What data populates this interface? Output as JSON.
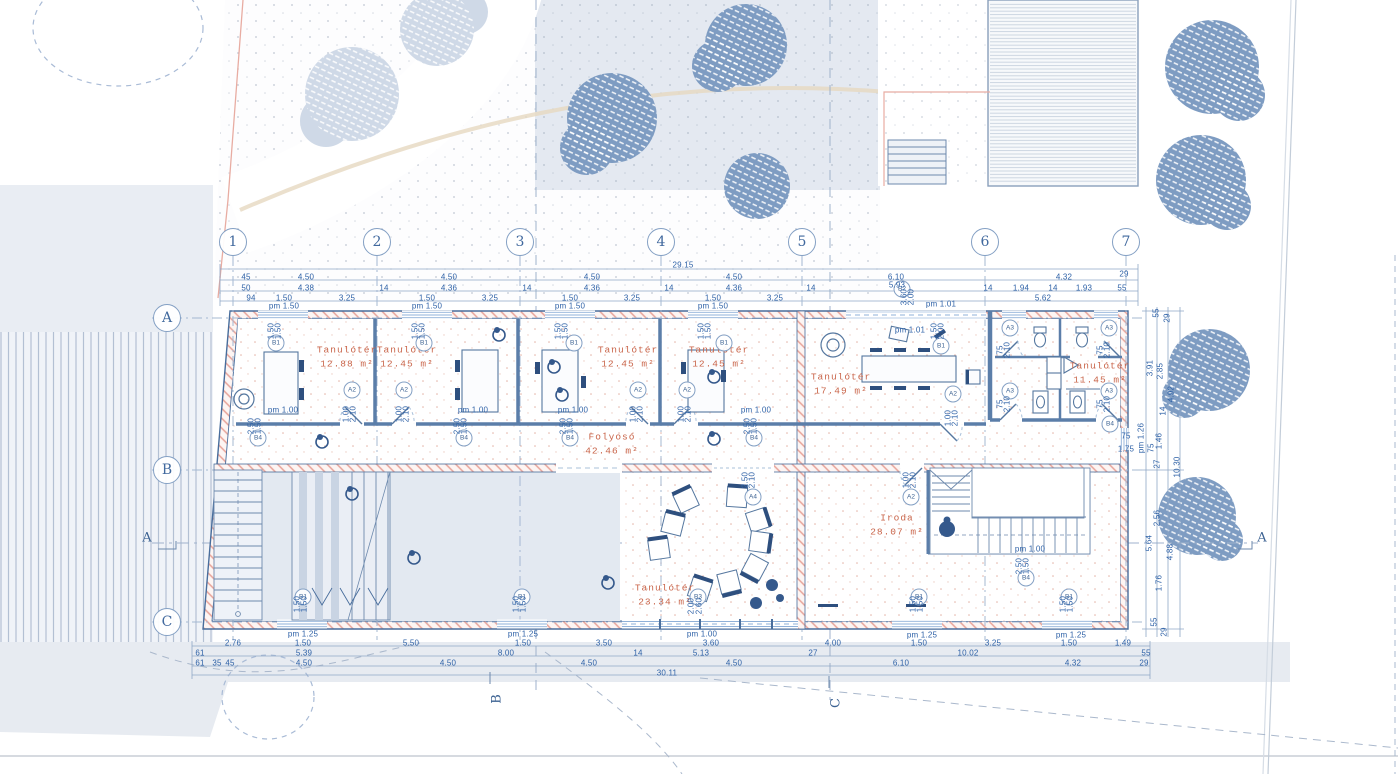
{
  "plan": {
    "title_note": "floor plan",
    "colors": {
      "dim_text": "#2f62a7",
      "room_text": "#c9654a",
      "wall_line": "#486d9c",
      "tree_fill": "#7e9cc2",
      "site_fill": "#e6eaf2",
      "hatch_red": "#e7a399"
    },
    "grid_cols": [
      {
        "n": "1",
        "x": 233,
        "y": 242
      },
      {
        "n": "2",
        "x": 377,
        "y": 242
      },
      {
        "n": "3",
        "x": 520,
        "y": 242
      },
      {
        "n": "4",
        "x": 661,
        "y": 242
      },
      {
        "n": "5",
        "x": 802,
        "y": 242
      },
      {
        "n": "6",
        "x": 985,
        "y": 242
      },
      {
        "n": "7",
        "x": 1126,
        "y": 242
      }
    ],
    "grid_rows": [
      {
        "n": "A",
        "x": 167,
        "y": 318
      },
      {
        "n": "B",
        "x": 167,
        "y": 470
      },
      {
        "n": "C",
        "x": 167,
        "y": 622
      }
    ],
    "sections": [
      {
        "n": "A",
        "x": 147,
        "y": 538
      },
      {
        "n": "A",
        "x": 1262,
        "y": 538
      },
      {
        "n": "B",
        "x": 497,
        "y": 699,
        "r": -90
      },
      {
        "n": "C",
        "x": 836,
        "y": 703,
        "r": -90
      }
    ],
    "rooms": [
      {
        "name": "Tanulótér",
        "area": "12.88 m²",
        "x": 347,
        "y": 357
      },
      {
        "name": "Tanulótér",
        "area": "12.45 m²",
        "x": 407,
        "y": 357
      },
      {
        "name": "Tanulótér",
        "area": "12.45 m²",
        "x": 628,
        "y": 357
      },
      {
        "name": "Tanulótér",
        "area": "12.45 m²",
        "x": 719,
        "y": 357
      },
      {
        "name": "Tanulótér",
        "area": "17.49 m²",
        "x": 841,
        "y": 384
      },
      {
        "name": "Tanulótér",
        "area": "11.45 m²",
        "x": 1100,
        "y": 373
      },
      {
        "name": "Folyosó",
        "area": "42.46 m²",
        "x": 612,
        "y": 444
      },
      {
        "name": "Tanulótér",
        "area": "23.34 m²",
        "x": 665,
        "y": 595
      },
      {
        "name": "Iroda",
        "area": "28.07 m²",
        "x": 897,
        "y": 525
      }
    ],
    "tags": [
      {
        "t": "A2",
        "x": 352,
        "y": 390
      },
      {
        "t": "A2",
        "x": 404,
        "y": 390
      },
      {
        "t": "A2",
        "x": 638,
        "y": 390
      },
      {
        "t": "A2",
        "x": 687,
        "y": 390
      },
      {
        "t": "A2",
        "x": 953,
        "y": 394
      },
      {
        "t": "A2",
        "x": 911,
        "y": 497
      },
      {
        "t": "A3",
        "x": 1010,
        "y": 328
      },
      {
        "t": "A3",
        "x": 1109,
        "y": 328
      },
      {
        "t": "A3",
        "x": 1010,
        "y": 391
      },
      {
        "t": "A3",
        "x": 1109,
        "y": 391
      },
      {
        "t": "A4",
        "x": 753,
        "y": 497
      },
      {
        "t": "B1",
        "x": 276,
        "y": 343
      },
      {
        "t": "B1",
        "x": 424,
        "y": 343
      },
      {
        "t": "B1",
        "x": 574,
        "y": 343
      },
      {
        "t": "B1",
        "x": 724,
        "y": 343
      },
      {
        "t": "B1",
        "x": 941,
        "y": 346
      },
      {
        "t": "B1",
        "x": 303,
        "y": 597
      },
      {
        "t": "B1",
        "x": 522,
        "y": 597
      },
      {
        "t": "B1",
        "x": 919,
        "y": 597
      },
      {
        "t": "B1",
        "x": 1069,
        "y": 597
      },
      {
        "t": "B2",
        "x": 902,
        "y": 289
      },
      {
        "t": "B3",
        "x": 698,
        "y": 597
      },
      {
        "t": "B4",
        "x": 258,
        "y": 438
      },
      {
        "t": "B4",
        "x": 464,
        "y": 438
      },
      {
        "t": "B4",
        "x": 570,
        "y": 438
      },
      {
        "t": "B4",
        "x": 754,
        "y": 438
      },
      {
        "t": "B4",
        "x": 1026,
        "y": 578
      },
      {
        "t": "B4",
        "x": 1110,
        "y": 424
      }
    ],
    "dim_labels": [
      {
        "t": "29.15",
        "x": 683,
        "y": 265
      },
      {
        "t": "45",
        "x": 246,
        "y": 277
      },
      {
        "t": "4.50",
        "x": 306,
        "y": 277
      },
      {
        "t": "4.50",
        "x": 449,
        "y": 277
      },
      {
        "t": "4.50",
        "x": 592,
        "y": 277
      },
      {
        "t": "4.50",
        "x": 734,
        "y": 277
      },
      {
        "t": "6.10",
        "x": 896,
        "y": 277
      },
      {
        "t": "4.32",
        "x": 1064,
        "y": 277
      },
      {
        "t": "29",
        "x": 1124,
        "y": 274
      },
      {
        "t": "50",
        "x": 246,
        "y": 288
      },
      {
        "t": "4.38",
        "x": 306,
        "y": 288
      },
      {
        "t": "14",
        "x": 384,
        "y": 288
      },
      {
        "t": "4.36",
        "x": 449,
        "y": 288
      },
      {
        "t": "14",
        "x": 527,
        "y": 288
      },
      {
        "t": "4.36",
        "x": 592,
        "y": 288
      },
      {
        "t": "14",
        "x": 669,
        "y": 288
      },
      {
        "t": "4.36",
        "x": 734,
        "y": 288
      },
      {
        "t": "14",
        "x": 811,
        "y": 288
      },
      {
        "t": "5.93",
        "x": 897,
        "y": 285
      },
      {
        "t": "14",
        "x": 988,
        "y": 288
      },
      {
        "t": "1.94",
        "x": 1021,
        "y": 288
      },
      {
        "t": "14",
        "x": 1053,
        "y": 288
      },
      {
        "t": "1.93",
        "x": 1084,
        "y": 288
      },
      {
        "t": "55",
        "x": 1122,
        "y": 288
      },
      {
        "t": "94",
        "x": 251,
        "y": 298
      },
      {
        "t": "1.50",
        "x": 284,
        "y": 298
      },
      {
        "t": "3.25",
        "x": 347,
        "y": 298
      },
      {
        "t": "1.50",
        "x": 427,
        "y": 298
      },
      {
        "t": "3.25",
        "x": 490,
        "y": 298
      },
      {
        "t": "1.50",
        "x": 570,
        "y": 298
      },
      {
        "t": "3.25",
        "x": 632,
        "y": 298
      },
      {
        "t": "1.50",
        "x": 713,
        "y": 298
      },
      {
        "t": "3.25",
        "x": 775,
        "y": 298
      },
      {
        "t": "5.62",
        "x": 1043,
        "y": 298
      },
      {
        "t": "pm 1.50",
        "x": 284,
        "y": 306
      },
      {
        "t": "pm 1.50",
        "x": 427,
        "y": 306
      },
      {
        "t": "pm 1.50",
        "x": 570,
        "y": 306
      },
      {
        "t": "pm 1.50",
        "x": 713,
        "y": 306
      },
      {
        "t": "pm 1.01",
        "x": 941,
        "y": 304
      },
      {
        "t": "3.60",
        "x": 904,
        "y": 297,
        "r": -90
      },
      {
        "t": "2.00",
        "x": 911,
        "y": 297,
        "r": -90
      },
      {
        "t": "pm 1.01",
        "x": 910,
        "y": 330
      },
      {
        "t": "1.50",
        "x": 934,
        "y": 331,
        "r": -90
      },
      {
        "t": "2.00",
        "x": 941,
        "y": 331,
        "r": -90
      },
      {
        "t": "pm 1.25",
        "x": 303,
        "y": 634
      },
      {
        "t": "pm 1.25",
        "x": 523,
        "y": 634
      },
      {
        "t": "pm 1.00",
        "x": 702,
        "y": 634
      },
      {
        "t": "pm 1.25",
        "x": 922,
        "y": 635
      },
      {
        "t": "pm 1.25",
        "x": 1071,
        "y": 635
      },
      {
        "t": "2.76",
        "x": 233,
        "y": 643
      },
      {
        "t": "1.50",
        "x": 303,
        "y": 643
      },
      {
        "t": "5.50",
        "x": 411,
        "y": 643
      },
      {
        "t": "1.50",
        "x": 523,
        "y": 643
      },
      {
        "t": "3.50",
        "x": 604,
        "y": 643
      },
      {
        "t": "3.60",
        "x": 711,
        "y": 643
      },
      {
        "t": "4.00",
        "x": 833,
        "y": 643
      },
      {
        "t": "1.50",
        "x": 919,
        "y": 643
      },
      {
        "t": "3.25",
        "x": 993,
        "y": 643
      },
      {
        "t": "1.50",
        "x": 1069,
        "y": 643
      },
      {
        "t": "1.49",
        "x": 1123,
        "y": 643
      },
      {
        "t": "61",
        "x": 200,
        "y": 653
      },
      {
        "t": "5.39",
        "x": 304,
        "y": 653
      },
      {
        "t": "8.00",
        "x": 506,
        "y": 653
      },
      {
        "t": "14",
        "x": 638,
        "y": 653
      },
      {
        "t": "5.13",
        "x": 701,
        "y": 653
      },
      {
        "t": "27",
        "x": 813,
        "y": 653
      },
      {
        "t": "10.02",
        "x": 968,
        "y": 653
      },
      {
        "t": "55",
        "x": 1146,
        "y": 653
      },
      {
        "t": "61",
        "x": 200,
        "y": 663
      },
      {
        "t": "35",
        "x": 217,
        "y": 663
      },
      {
        "t": "45",
        "x": 230,
        "y": 663
      },
      {
        "t": "4.50",
        "x": 304,
        "y": 663
      },
      {
        "t": "4.50",
        "x": 448,
        "y": 663
      },
      {
        "t": "4.50",
        "x": 589,
        "y": 663
      },
      {
        "t": "4.50",
        "x": 734,
        "y": 663
      },
      {
        "t": "6.10",
        "x": 901,
        "y": 663
      },
      {
        "t": "4.32",
        "x": 1073,
        "y": 663
      },
      {
        "t": "29",
        "x": 1144,
        "y": 663
      },
      {
        "t": "30.11",
        "x": 667,
        "y": 673
      },
      {
        "t": "55",
        "x": 1156,
        "y": 313,
        "r": -90
      },
      {
        "t": "29",
        "x": 1167,
        "y": 318,
        "r": -90
      },
      {
        "t": "3.91",
        "x": 1150,
        "y": 368,
        "r": -90
      },
      {
        "t": "2.85",
        "x": 1160,
        "y": 371,
        "r": -90
      },
      {
        "t": "4.92",
        "x": 1171,
        "y": 394,
        "r": -90
      },
      {
        "t": "14",
        "x": 1163,
        "y": 411,
        "r": -90
      },
      {
        "t": "1.46",
        "x": 1159,
        "y": 441,
        "r": -90
      },
      {
        "t": "75",
        "x": 1151,
        "y": 448,
        "r": -90
      },
      {
        "t": "27",
        "x": 1157,
        "y": 464,
        "r": -90
      },
      {
        "t": "pm 1.26",
        "x": 1141,
        "y": 438,
        "r": -90
      },
      {
        "t": "10.30",
        "x": 1177,
        "y": 467,
        "r": -90
      },
      {
        "t": "2.56",
        "x": 1157,
        "y": 518,
        "r": -90
      },
      {
        "t": "5.64",
        "x": 1149,
        "y": 543,
        "r": -90
      },
      {
        "t": "4.88",
        "x": 1170,
        "y": 552,
        "r": -90
      },
      {
        "t": "1.76",
        "x": 1159,
        "y": 583,
        "r": -90
      },
      {
        "t": "55",
        "x": 1154,
        "y": 622,
        "r": -90
      },
      {
        "t": "29",
        "x": 1164,
        "y": 632,
        "r": -90
      },
      {
        "t": "75",
        "x": 1126,
        "y": 436
      },
      {
        "t": "1.75",
        "x": 1126,
        "y": 449
      },
      {
        "t": "pm 1.00",
        "x": 283,
        "y": 410
      },
      {
        "t": "pm 1.00",
        "x": 473,
        "y": 410
      },
      {
        "t": "pm 1.00",
        "x": 573,
        "y": 410
      },
      {
        "t": "pm 1.00",
        "x": 756,
        "y": 410
      },
      {
        "t": "pm 1.00",
        "x": 1030,
        "y": 549
      },
      {
        "t": "1.00",
        "x": 346,
        "y": 414,
        "r": -90
      },
      {
        "t": "2.10",
        "x": 353,
        "y": 414,
        "r": -90
      },
      {
        "t": "1.00",
        "x": 399,
        "y": 414,
        "r": -90
      },
      {
        "t": "2.10",
        "x": 406,
        "y": 414,
        "r": -90
      },
      {
        "t": "1.00",
        "x": 633,
        "y": 414,
        "r": -90
      },
      {
        "t": "2.10",
        "x": 640,
        "y": 414,
        "r": -90
      },
      {
        "t": "1.00",
        "x": 681,
        "y": 414,
        "r": -90
      },
      {
        "t": "2.10",
        "x": 688,
        "y": 414,
        "r": -90
      },
      {
        "t": "1.00",
        "x": 948,
        "y": 418,
        "r": -90
      },
      {
        "t": "2.10",
        "x": 955,
        "y": 418,
        "r": -90
      },
      {
        "t": "1.00",
        "x": 906,
        "y": 480,
        "r": -90
      },
      {
        "t": "2.10",
        "x": 913,
        "y": 480,
        "r": -90
      },
      {
        "t": "1.50",
        "x": 271,
        "y": 331,
        "r": -90
      },
      {
        "t": "1.50",
        "x": 278,
        "y": 331,
        "r": -90
      },
      {
        "t": "1.50",
        "x": 415,
        "y": 331,
        "r": -90
      },
      {
        "t": "1.50",
        "x": 422,
        "y": 331,
        "r": -90
      },
      {
        "t": "1.50",
        "x": 558,
        "y": 331,
        "r": -90
      },
      {
        "t": "1.50",
        "x": 565,
        "y": 331,
        "r": -90
      },
      {
        "t": "1.50",
        "x": 701,
        "y": 331,
        "r": -90
      },
      {
        "t": "1.50",
        "x": 708,
        "y": 331,
        "r": -90
      },
      {
        "t": "2.50",
        "x": 251,
        "y": 426,
        "r": -90
      },
      {
        "t": "1.50",
        "x": 258,
        "y": 426,
        "r": -90
      },
      {
        "t": "2.50",
        "x": 457,
        "y": 426,
        "r": -90
      },
      {
        "t": "1.50",
        "x": 464,
        "y": 426,
        "r": -90
      },
      {
        "t": "2.50",
        "x": 563,
        "y": 426,
        "r": -90
      },
      {
        "t": "1.50",
        "x": 570,
        "y": 426,
        "r": -90
      },
      {
        "t": "2.50",
        "x": 747,
        "y": 426,
        "r": -90
      },
      {
        "t": "1.50",
        "x": 754,
        "y": 426,
        "r": -90
      },
      {
        "t": "2.50",
        "x": 1019,
        "y": 566,
        "r": -90
      },
      {
        "t": "1.50",
        "x": 1026,
        "y": 566,
        "r": -90
      },
      {
        "t": "2.50",
        "x": 745,
        "y": 480,
        "r": -90
      },
      {
        "t": "2.10",
        "x": 752,
        "y": 480,
        "r": -90
      },
      {
        "t": "2.00",
        "x": 691,
        "y": 606,
        "r": -90
      },
      {
        "t": "2.60",
        "x": 699,
        "y": 606,
        "r": -90
      },
      {
        "t": "1.50",
        "x": 297,
        "y": 604,
        "r": -90
      },
      {
        "t": "1.50",
        "x": 304,
        "y": 604,
        "r": -90
      },
      {
        "t": "1.50",
        "x": 516,
        "y": 604,
        "r": -90
      },
      {
        "t": "1.50",
        "x": 523,
        "y": 604,
        "r": -90
      },
      {
        "t": "1.50",
        "x": 913,
        "y": 604,
        "r": -90
      },
      {
        "t": "1.50",
        "x": 920,
        "y": 604,
        "r": -90
      },
      {
        "t": "1.50",
        "x": 1063,
        "y": 604,
        "r": -90
      },
      {
        "t": "1.50",
        "x": 1070,
        "y": 604,
        "r": -90
      },
      {
        "t": "75",
        "x": 1000,
        "y": 350,
        "r": -90
      },
      {
        "t": "2.10",
        "x": 1007,
        "y": 350,
        "r": -90
      },
      {
        "t": "75",
        "x": 1100,
        "y": 350,
        "r": -90
      },
      {
        "t": "2.10",
        "x": 1107,
        "y": 350,
        "r": -90
      },
      {
        "t": "75",
        "x": 1000,
        "y": 404,
        "r": -90
      },
      {
        "t": "2.10",
        "x": 1007,
        "y": 404,
        "r": -90
      },
      {
        "t": "75",
        "x": 1100,
        "y": 404,
        "r": -90
      },
      {
        "t": "2.10",
        "x": 1107,
        "y": 404,
        "r": -90
      }
    ]
  }
}
